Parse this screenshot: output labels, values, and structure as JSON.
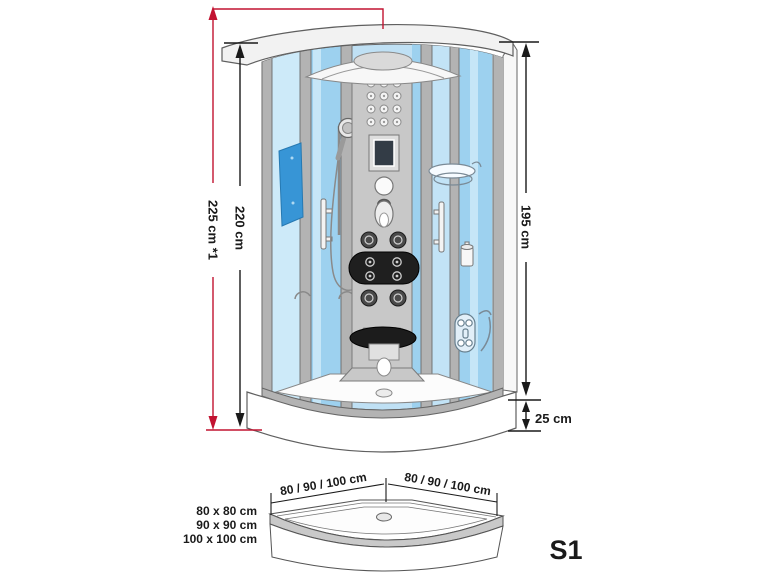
{
  "colors": {
    "dimension_red": "#c21331",
    "dimension_black": "#1a1a1a",
    "model_red": "#bc3a46",
    "glass_blue_light": "#cdeaf9",
    "glass_blue_mid": "#9dd1ef",
    "mirror_blue": "#3795d6",
    "frame_gray": "#b3b3b3"
  },
  "dimensions": {
    "total_height": "225 cm *1",
    "cabin_height": "220 cm",
    "inner_height": "195 cm",
    "tray_height": "25 cm"
  },
  "tray": {
    "width_left": "80 / 90 / 100 cm",
    "width_right": "80 / 90 / 100 cm",
    "sizes": [
      "80 x 80 cm",
      "90 x 90 cm",
      "100 x 100 cm"
    ]
  },
  "model": "S1"
}
